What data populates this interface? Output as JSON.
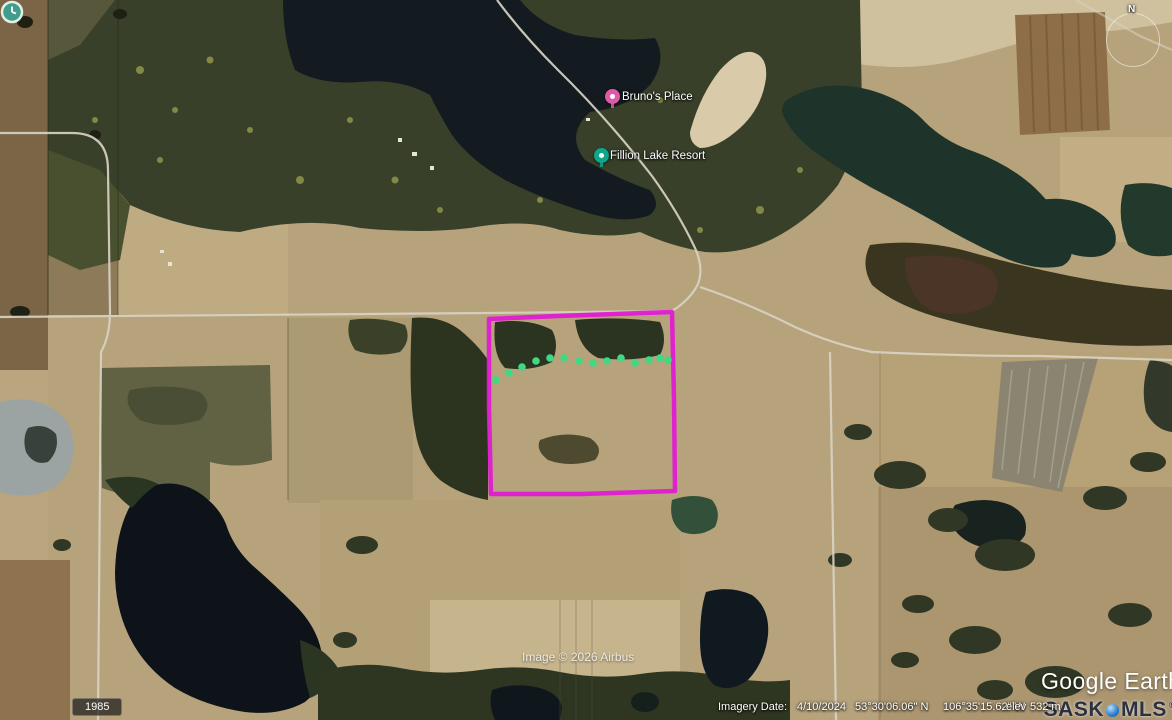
{
  "map": {
    "provider_logo": "Google Earth",
    "labels": [
      {
        "name": "Bruno's Place",
        "pin_color": "#dd5ba6",
        "pin_icon": "lodging"
      },
      {
        "name": "Fillion Lake Resort",
        "pin_color": "#0fa689",
        "pin_icon": "resort"
      }
    ],
    "parcel": {
      "color": "#e01bd2",
      "points": "489,319 558,316 672,312 674,400 675,491 582,494 491,494 489,408"
    },
    "waypoint_dots": {
      "color": "#3fd981",
      "points": [
        [
          496,
          380
        ],
        [
          509,
          373
        ],
        [
          522,
          367
        ],
        [
          536,
          361
        ],
        [
          550,
          358
        ],
        [
          564,
          358
        ],
        [
          579,
          361
        ],
        [
          593,
          363
        ],
        [
          607,
          361
        ],
        [
          621,
          358
        ],
        [
          635,
          363
        ],
        [
          649,
          360
        ],
        [
          660,
          358
        ],
        [
          668,
          360
        ]
      ]
    },
    "compass": {
      "label": "N"
    },
    "watermarks": {
      "image_credit": "Image © 2026 Airbus",
      "mls_left": "SASK",
      "mls_right": "MLS",
      "mls_reg": "®"
    },
    "status_bar": {
      "imagery_date_label": "Imagery Date:",
      "imagery_date": "4/10/2024",
      "latitude": "53°30'06.06\" N",
      "longitude": "106°35'15.62\" W",
      "elev_label": "elev",
      "elevation": "532 m"
    },
    "history": {
      "oldest_year": "1985"
    }
  }
}
